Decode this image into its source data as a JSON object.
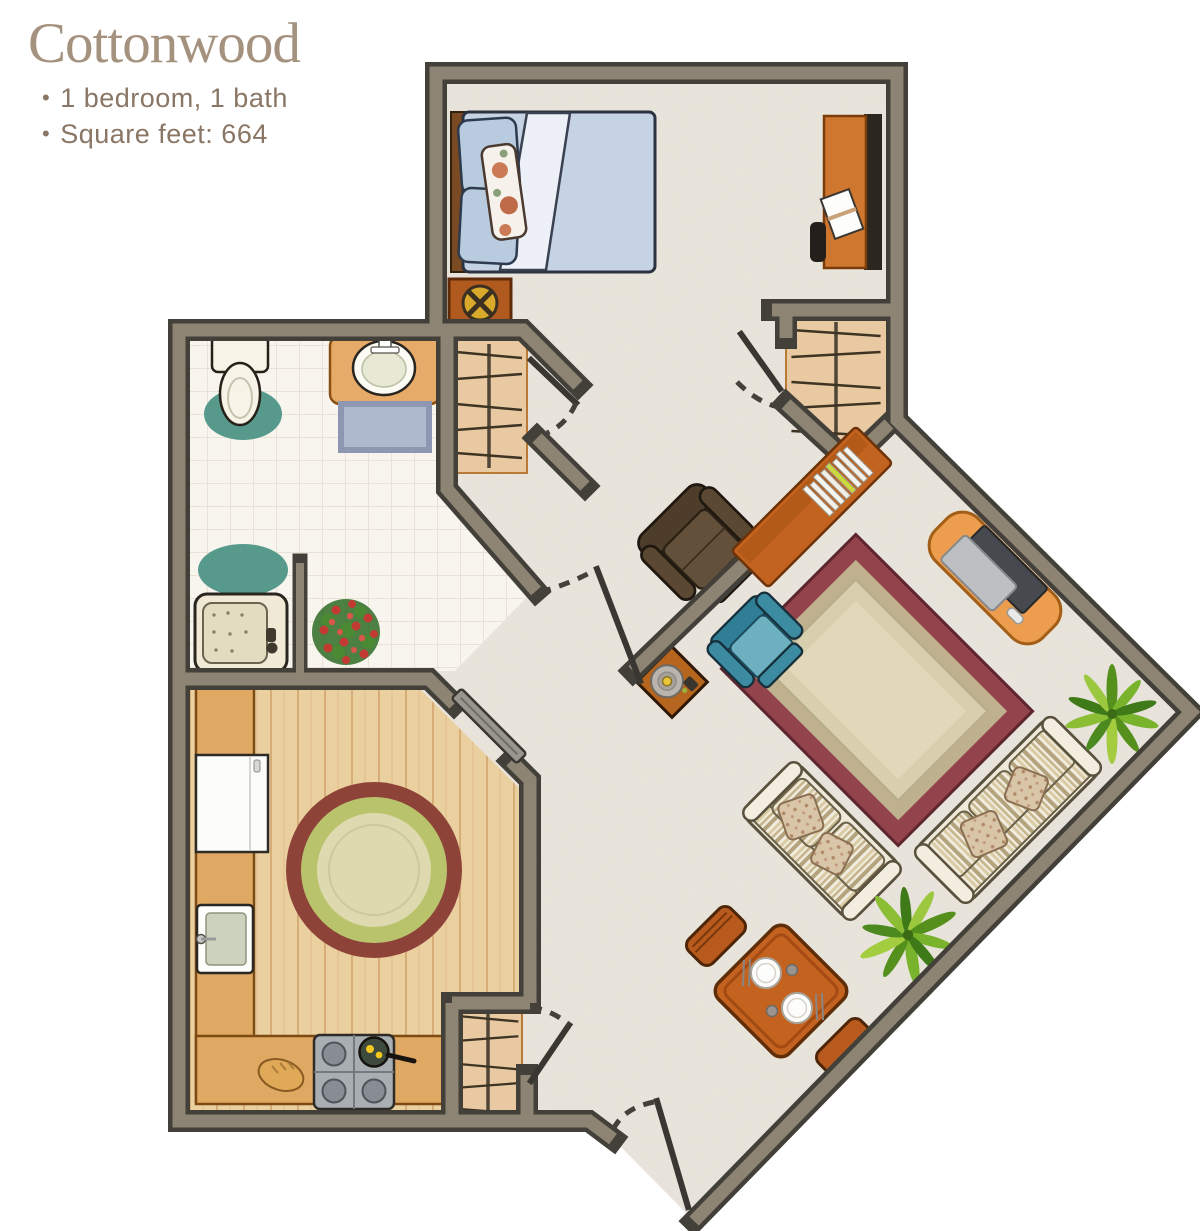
{
  "header": {
    "title": "Cottonwood",
    "bullet_char": "•",
    "details": [
      "1 bedroom, 1 bath",
      "Square feet: 664"
    ]
  },
  "floor_plan": {
    "name": "Cottonwood one-bedroom floor plan",
    "rooms": [
      "bedroom",
      "bathroom",
      "kitchen",
      "living-dining area",
      "entry hall"
    ],
    "furniture_icons": [
      "bed-icon",
      "desk-icon",
      "nightstand-compass-icon",
      "closet-hangers-icon",
      "toilet-icon",
      "vanity-sink-icon",
      "bath-mat-icon",
      "walk-in-tub-icon",
      "flower-plant-icon",
      "refrigerator-icon",
      "kitchen-sink-icon",
      "stove-with-pan-icon",
      "bread-icon",
      "round-rug-icon",
      "sliding-door-icon",
      "bookshelf-icon",
      "recliner-icon",
      "teal-armchair-icon",
      "record-table-icon",
      "area-rug-icon",
      "tv-console-icon",
      "loveseat-icon",
      "sofa-icon",
      "palm-plant-icon",
      "dining-table-icon",
      "door-swing-icon"
    ]
  },
  "palette": {
    "background": "#ffffff",
    "title_text": "#a5927e",
    "detail_text": "#8a7665",
    "wall_fill": "#8d8473",
    "wall_outline": "#43403a",
    "carpet": "#eae6dd",
    "tile": "#f8f5ef",
    "wood_floor": "#eacf9f",
    "counter_wood": "#e0a963",
    "closet_wood": "#e9c9a2",
    "accent_teal": "#579a8c",
    "rug_red": "#93434c",
    "bed_blue": "#c5d3e4",
    "furniture_orange": "#c4621f"
  }
}
